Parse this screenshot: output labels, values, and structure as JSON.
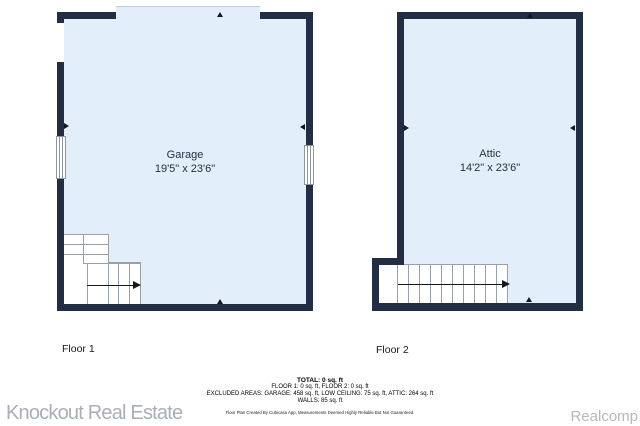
{
  "colors": {
    "wall": "#222e44",
    "room_fill": "#e2eef9",
    "stair_line": "#9aa0a8",
    "watermark": "#a9aeb7"
  },
  "floors": [
    {
      "label": "Floor 1",
      "room_name": "Garage",
      "room_dimensions": "19'5\" x 23'6\""
    },
    {
      "label": "Floor 2",
      "room_name": "Attic",
      "room_dimensions": "14'2\" x 23'6\""
    }
  ],
  "summary": {
    "total": "TOTAL: 0 sq. ft",
    "floors_line": "FLOOR 1: 0 sq. ft, FLOOR 2: 0 sq. ft",
    "excluded_line": "EXCLUDED AREAS: GARAGE: 458 sq. ft, LOW CEILING: 75 sq. ft, ATTIC: 264 sq. ft",
    "walls_line": "WALLS: 85 sq. ft",
    "disclaimer": "Floor Plan Created By Cubicasa App, Measurements Deemed Highly Reliable But Not Guaranteed."
  },
  "watermarks": {
    "left": "Knockout Real Estate",
    "right": "Realcomp"
  }
}
